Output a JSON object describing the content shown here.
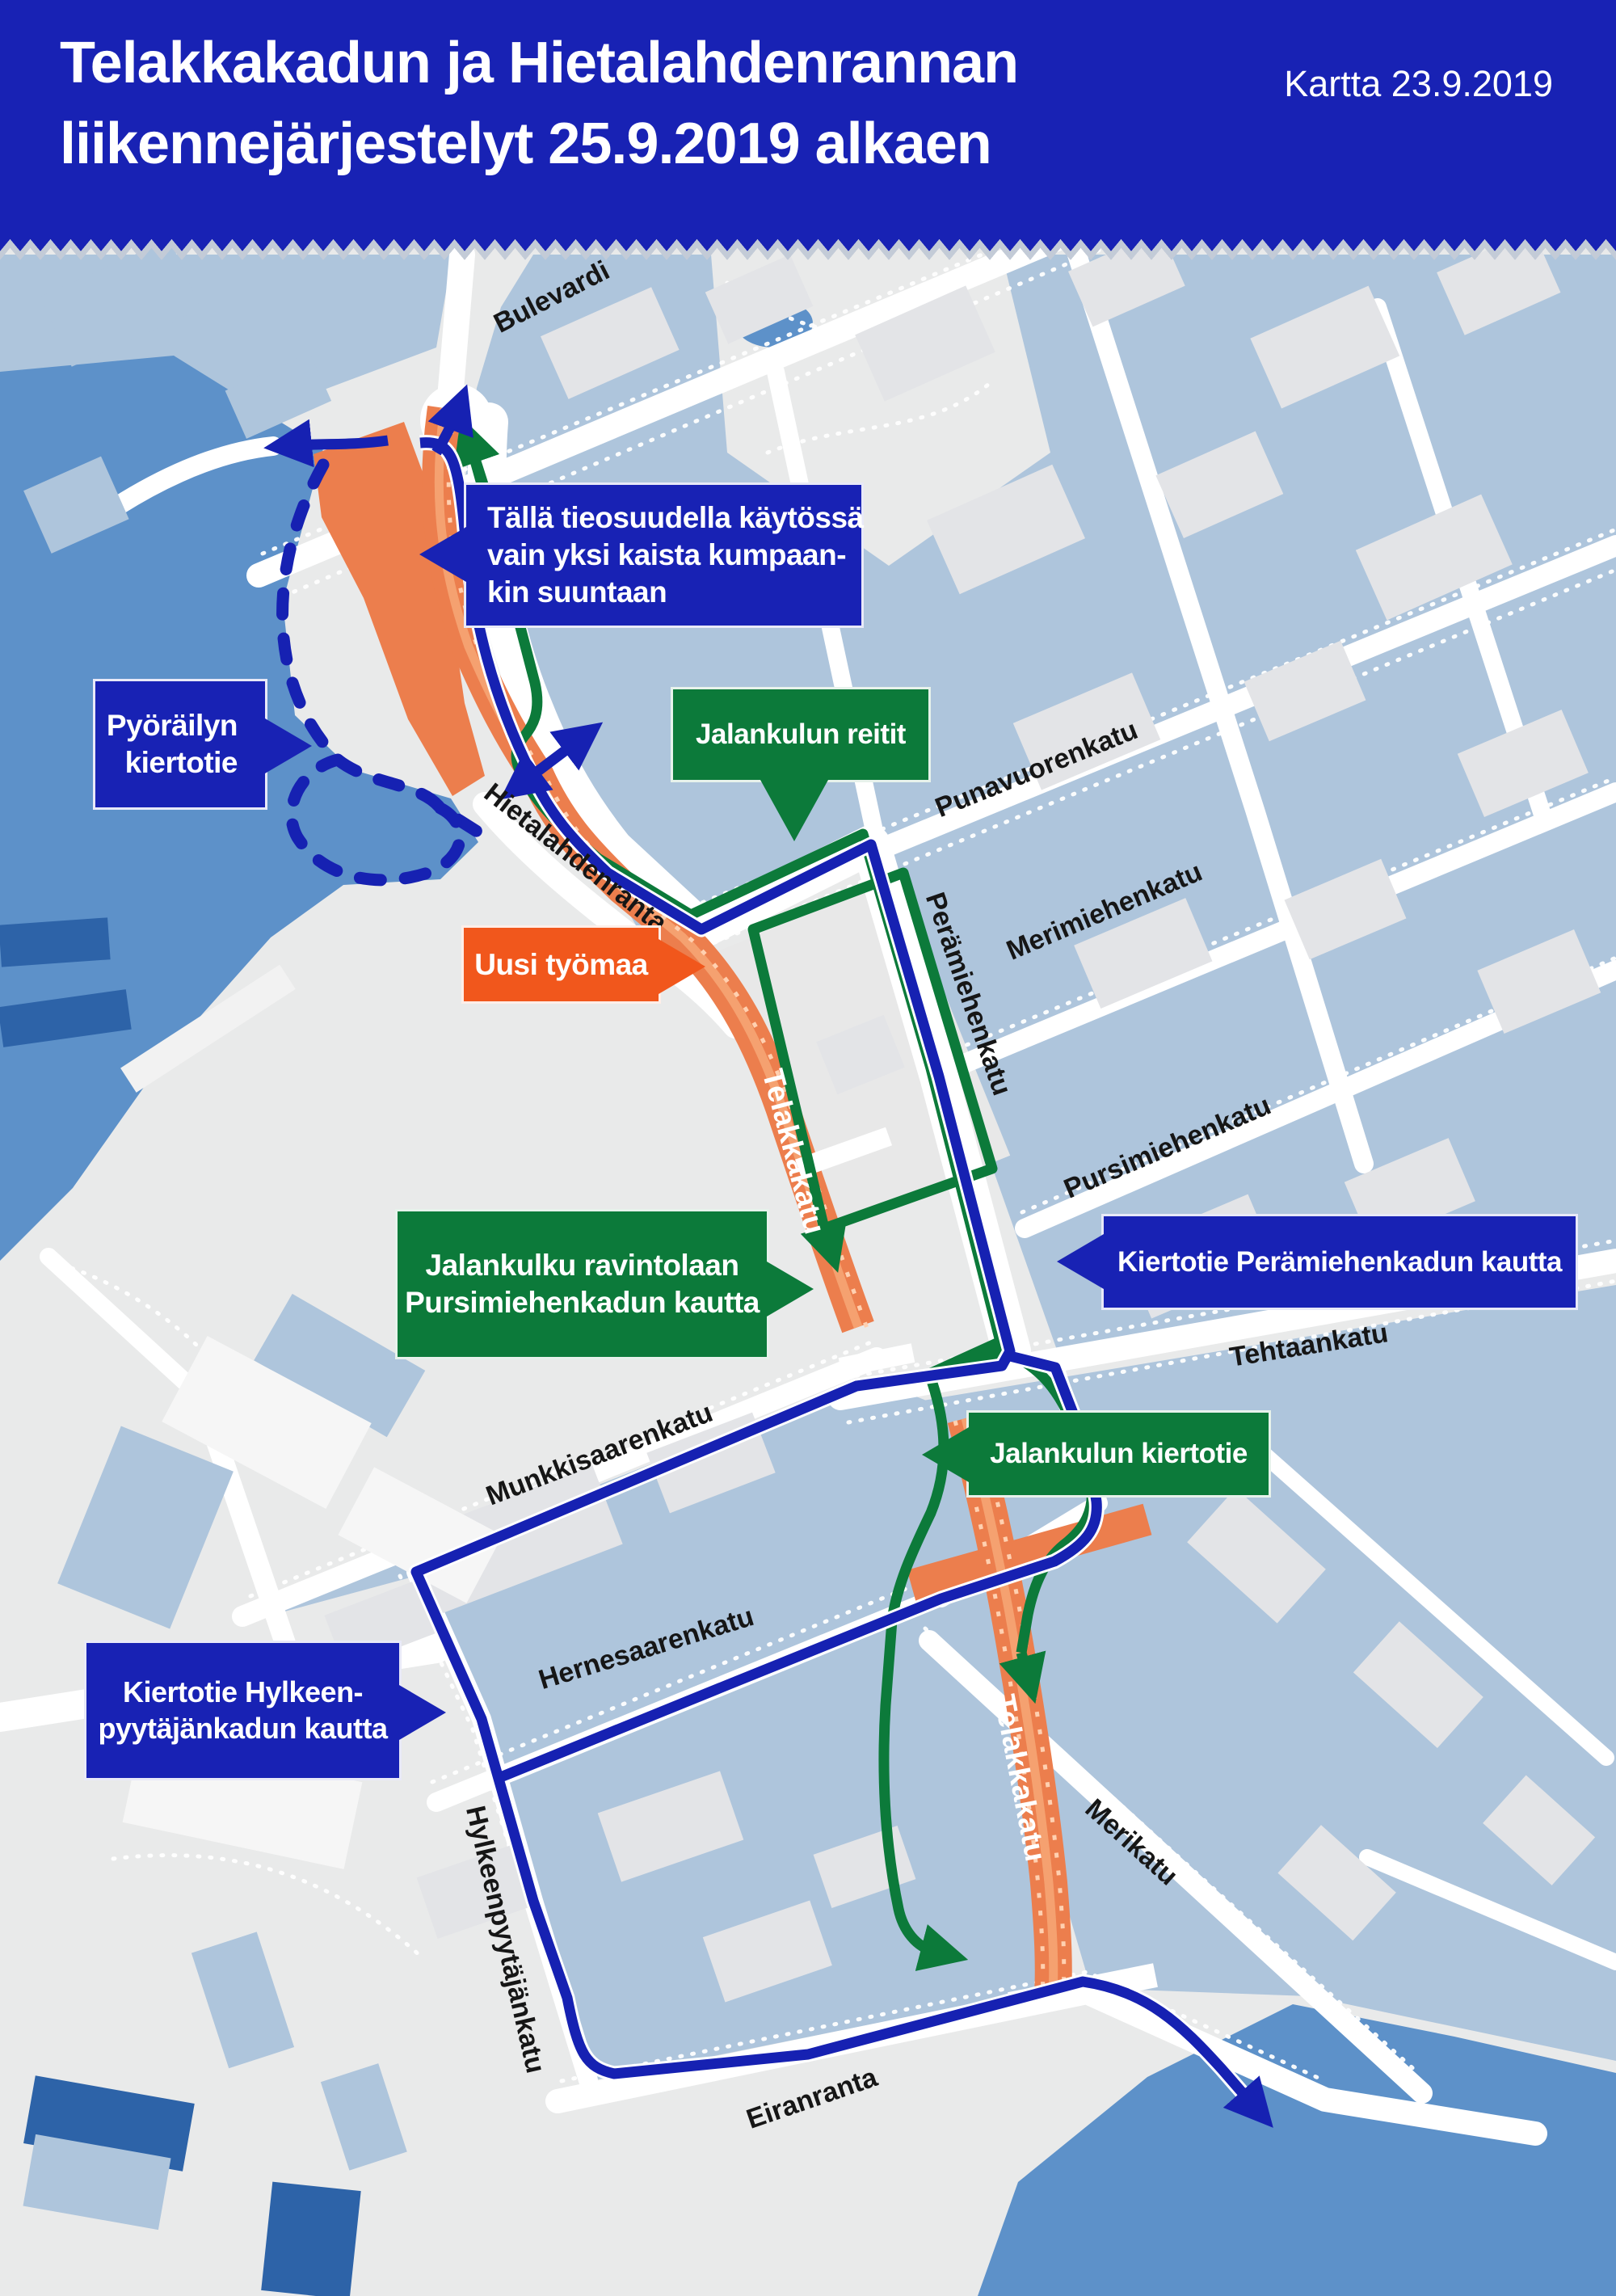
{
  "header": {
    "title_line1": "Telakkakadun ja Hietalahdenrannan",
    "title_line2": "liikennejärjestelyt 25.9.2019 alkaen",
    "date_label": "Kartta 23.9.2019"
  },
  "callouts": {
    "one_lane": {
      "lines": [
        "Tällä tieosuudella käytössä",
        "vain yksi kaista kumpaan-",
        "kin suuntaan"
      ]
    },
    "cycling_detour": {
      "lines": [
        "Pyöräilyn",
        "kiertotie"
      ]
    },
    "pedestrian_routes": {
      "lines": [
        "Jalankulun reitit"
      ]
    },
    "new_worksite": {
      "lines": [
        "Uusi työmaa"
      ]
    },
    "walk_to_restaurant": {
      "lines": [
        "Jalankulku ravintolaan",
        "Pursimiehenkadun kautta"
      ]
    },
    "detour_peramiehenkatu": {
      "lines": [
        "Kiertotie Perämiehenkadun kautta"
      ]
    },
    "pedestrian_detour": {
      "lines": [
        "Jalankulun kiertotie"
      ]
    },
    "detour_hylkeenpyytajankatu": {
      "lines": [
        "Kiertotie Hylkeen-",
        "pyytäjänkadun kautta"
      ]
    }
  },
  "streets": {
    "bulevardi": "Bulevardi",
    "hietalahdenranta": "Hietalahdenranta",
    "punavuorenkatu": "Punavuorenkatu",
    "peramiehenkatu": "Perämiehenkatu",
    "merimiehenkatu": "Merimiehenkatu",
    "pursimiehenkatu": "Pursimiehenkatu",
    "tehtaankatu": "Tehtaankatu",
    "munkkisaarenkatu": "Munkkisaarenkatu",
    "hernesaarenkatu": "Hernesaarenkatu",
    "hylkeenpyytajankatu": "Hylkeenpyytäjänkatu",
    "merikatu": "Merikatu",
    "eiranranta": "Eiranranta",
    "telakkakatu": "Telakkakatu"
  },
  "colors": {
    "header_blue": "#1822b4",
    "detour_route_blue": "#1621b2",
    "pedestrian_route_green": "#0c7a3a",
    "worksite_road_orange": "#ec7e4d",
    "worksite_callout_orange": "#f1571c",
    "water_blue": "#5d91c9",
    "dock_blue": "#2d63a8",
    "city_block_slate": "#aec5dc",
    "land_gray": "#e9eaea"
  }
}
